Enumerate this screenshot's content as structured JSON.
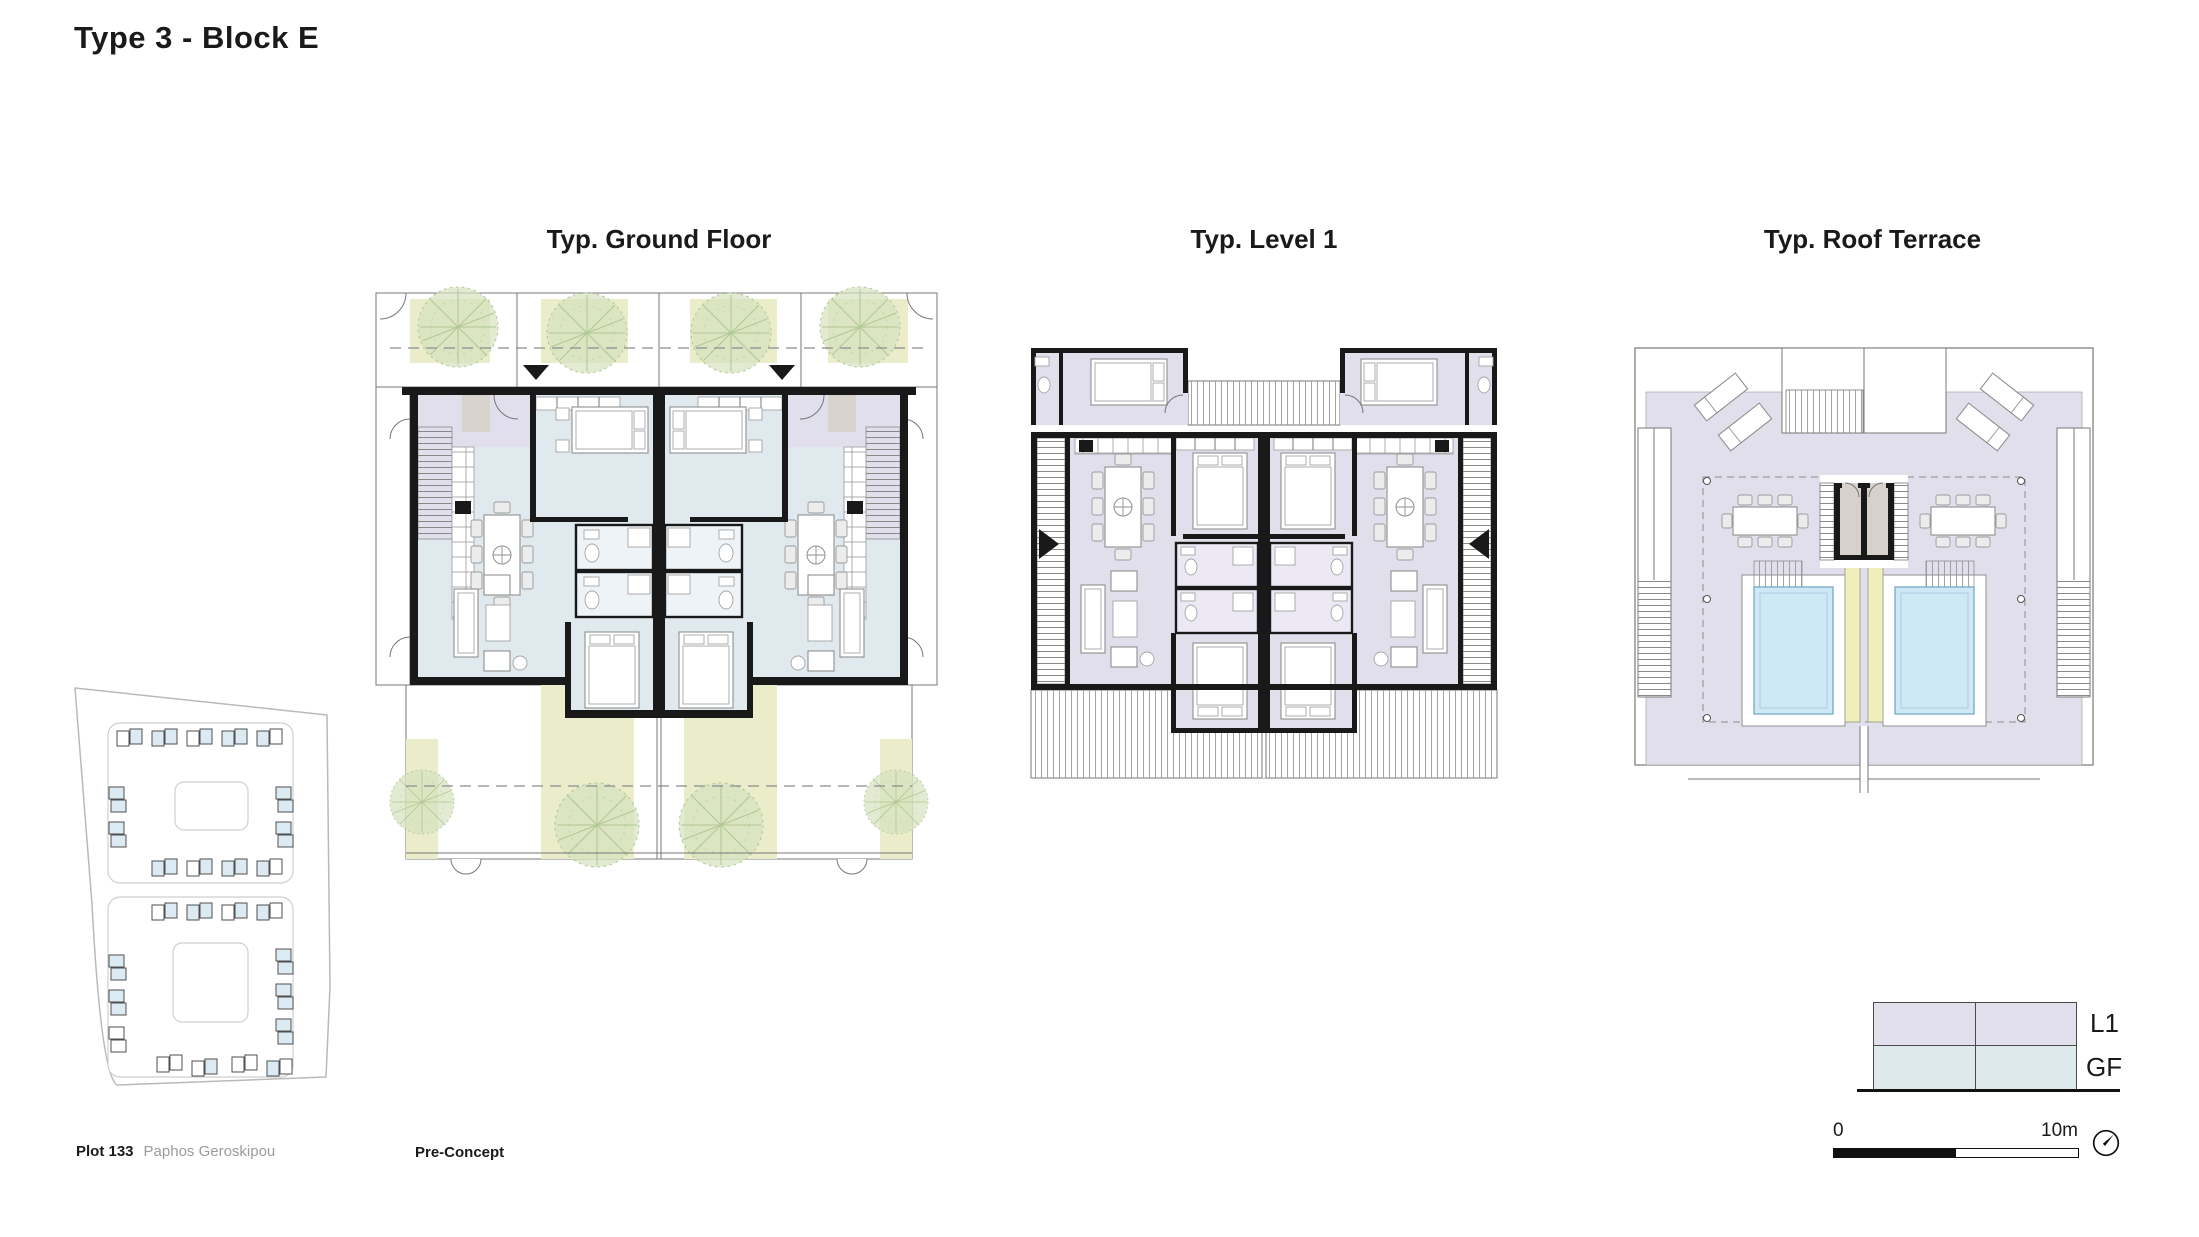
{
  "page": {
    "title": "Type 3 - Block E"
  },
  "plans": [
    {
      "id": "ground-floor",
      "title": "Typ. Ground Floor"
    },
    {
      "id": "level-1",
      "title": "Typ. Level 1"
    },
    {
      "id": "roof-terrace",
      "title": "Typ. Roof Terrace"
    }
  ],
  "footer": {
    "plot_label": "Plot 133",
    "plot_location": "Paphos Geroskipou",
    "stage": "Pre-Concept"
  },
  "legend": {
    "items": [
      {
        "label": "L1",
        "color": "#e2dfed"
      },
      {
        "label": "GF",
        "color": "#dee9ee"
      }
    ]
  },
  "scale_bar": {
    "start": "0",
    "end": "10m"
  },
  "colors": {
    "wall": "#191919",
    "garden": "#eaecca",
    "pool": "#cfe8f6",
    "planter": "#efeebd",
    "site_unit": "#dcebf3"
  }
}
